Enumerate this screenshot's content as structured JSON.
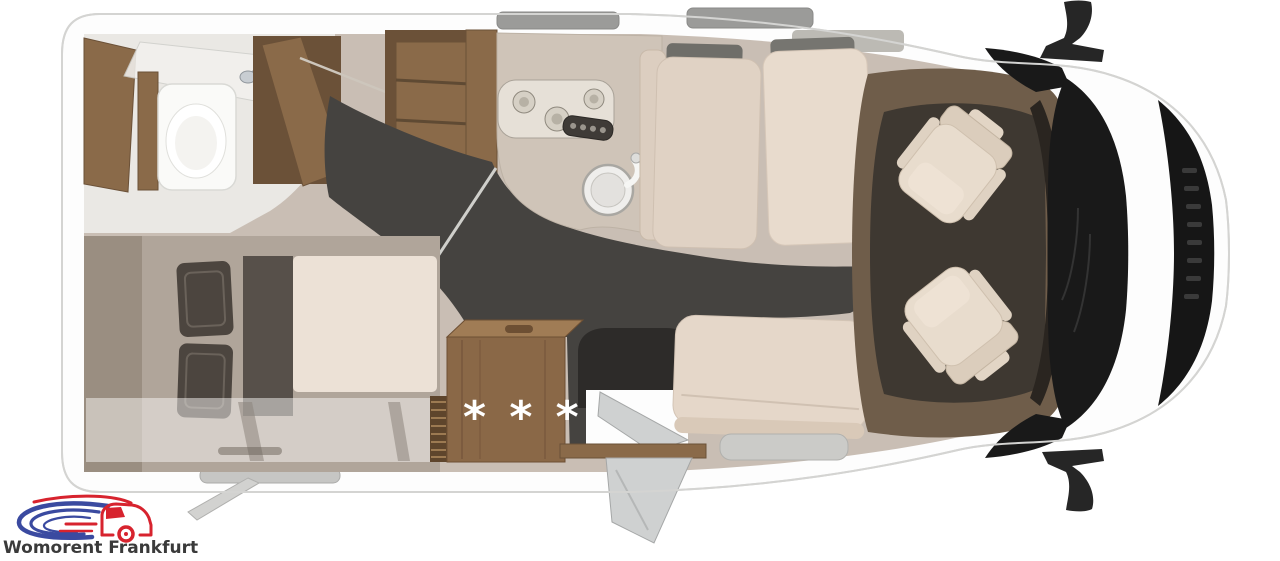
{
  "page": {
    "width": 1280,
    "height": 561,
    "background": "#ffffff"
  },
  "branding": {
    "logo_text": "Womorent Frankfurt",
    "colors": {
      "red": "#d7232e",
      "blue": "#3a4aa0",
      "text": "#3a3a3a"
    }
  },
  "floorplan": {
    "stars_label": "* * *",
    "star_color": "#ffffff",
    "palette": {
      "body_white": "#fdfdfd",
      "outline_gray": "#d4d4d2",
      "interior_beige": "#c9beb4",
      "walkway_dark": "#454340",
      "wood": "#8a6a49",
      "wood_dark": "#6b5138",
      "mattress_cream": "#ece1d6",
      "seat_cream": "#e6d9cb",
      "cab_floor_dark": "#3e3831",
      "glass_black": "#191919"
    }
  }
}
